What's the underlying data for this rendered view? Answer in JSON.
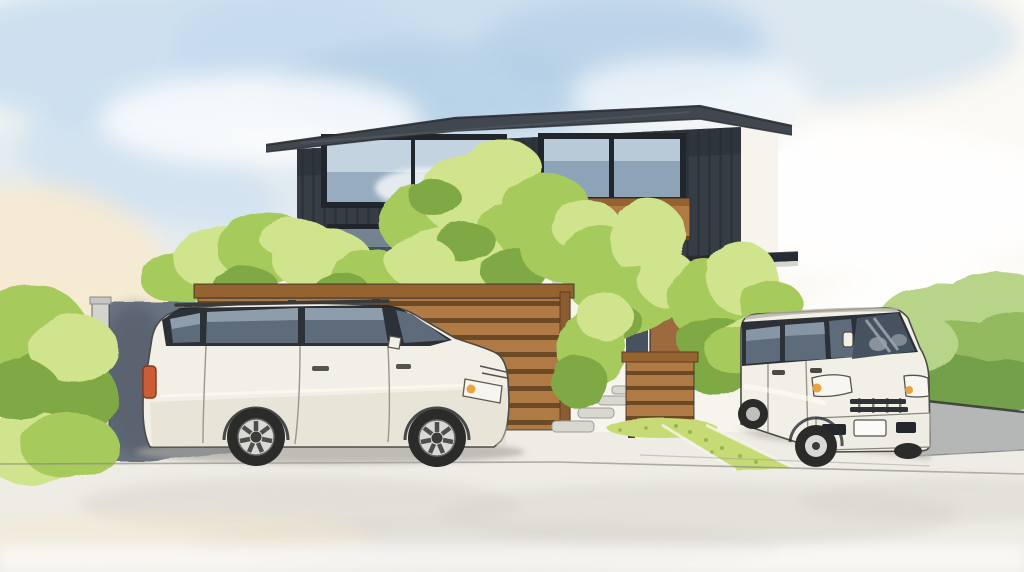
{
  "scene": {
    "medium": "watercolor illustration",
    "description": "Watercolor painting of a modern two-story house with dark charcoal vertical-board siding and a low-pitched overhanging roof, fronted by leafy green garden trees, horizontal wooden slat fences, a gray concrete side wall, stepping stones to a wooden entry door, and two parked white vehicles: a station wagon in the left carport and a boxy kei van in the right driveway, under a soft blue watercolor sky.",
    "objects": {
      "sky": "soft blue watercolor sky with warm cream tint at left",
      "house": "two-story dark-sided modern house",
      "upper_left_window": "large picture window reflecting sky",
      "upper_right_window": "two-pane window with wood flower-box trim",
      "entry": "wood front door with dark sidelight windows",
      "fences": "horizontal wood slat screen fence and low slat gate panel",
      "left_wall": "light gray concrete wall with shadowed carport face",
      "right_wall": "low gray retaining wall with green hedge",
      "left_car": "white station wagon with roof rails",
      "right_car": "white kei box van facing viewer",
      "ground": "pale paved driveway with stepping stones and diagonal grass strip"
    }
  },
  "palette": {
    "paper": "#fbf9f3",
    "sky_blue": "#c6dcee",
    "sky_blue_deep": "#a9c9e2",
    "warm_cream": "#f6e9cf",
    "cloud_white": "#ffffff",
    "roof_gray": "#41474f",
    "ink": "#2a2d31",
    "siding": "#373d45",
    "siding_line": "#1f242a",
    "window_frame": "#20262c",
    "glass_sky": "#c3d3e0",
    "glass_sky_deep": "#8da3b8",
    "glass_dark": "#46525f",
    "wood": "#b07a45",
    "wood_gap": "#6d4a26",
    "wood_cap": "#95632f",
    "door_wood": "#9c6a3d",
    "wall_white": "#f6f4ed",
    "eave_dark": "#262c33",
    "fascia": "#d6d5cf",
    "concrete_light": "#d3d4d0",
    "concrete_shadow": "#6a7380",
    "leaf_light": "#cfe48c",
    "leaf_mid": "#a6cb5c",
    "leaf_deep": "#7fa944",
    "leaf_dark": "#69953c",
    "trunk": "#6f4e2a",
    "grass": "#c6db74",
    "grass_dark": "#9ab54e",
    "stone": "#d8d7d0",
    "pavement": "#eeece5",
    "pavement_wash": "#d8d5cd",
    "car_body": "#f2efe6",
    "car_shade": "#dcd6c7",
    "car_glass": "#5d6b7b",
    "car_glass_light": "#a4b2c0",
    "tire": "#2b2b29",
    "rim": "#d9d9d5",
    "taillight": "#cb5c36",
    "amber": "#e9a440",
    "plate": "#fbfaf6",
    "bumper_dark": "#24272c",
    "hedge_light": "#b7d488",
    "hedge_mid": "#93ba5f",
    "hedge_dark": "#74a04c",
    "wall_right": "#b4b7b5"
  }
}
